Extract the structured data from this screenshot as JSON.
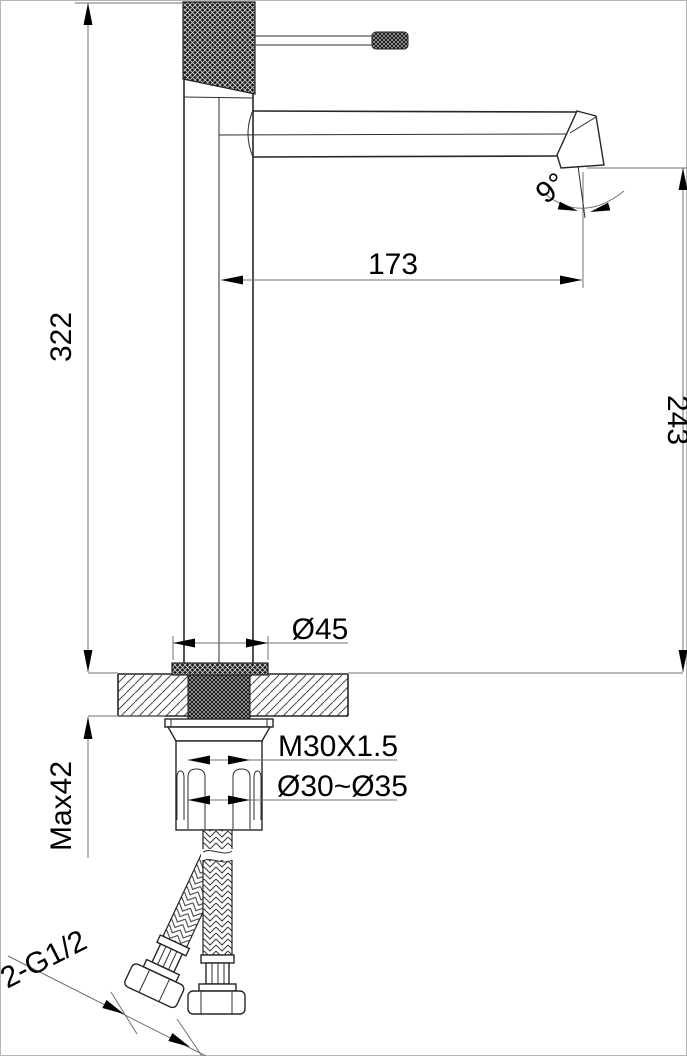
{
  "meta": {
    "drawing_type": "faucet dimensional technical drawing",
    "background": "#ffffff",
    "object_line_color": "#262626",
    "dimension_line_color": "#707070",
    "text_color": "#000000"
  },
  "labels": {
    "overall_height": "322",
    "spout_reach": "173",
    "outlet_height": "243",
    "outlet_angle": "9°",
    "base_diameter": "Ø45",
    "mounting_thread": "M30X1.5",
    "hole_range": "Ø30~Ø35",
    "max_deck_thickness": "Max42",
    "inlet_hoses": "2-G1/2"
  }
}
